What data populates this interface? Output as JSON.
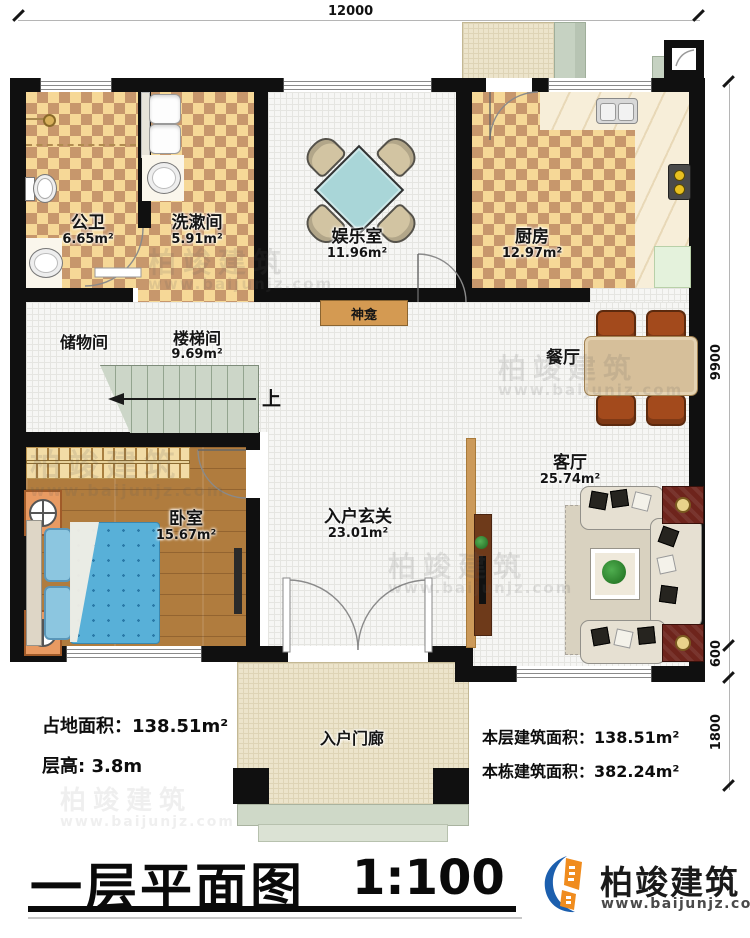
{
  "title": {
    "text": "一层平面图",
    "scale": "1:100"
  },
  "brand": {
    "name": "柏竣建筑",
    "url": "www.baijunjz.com"
  },
  "watermark": {
    "name": "柏竣建筑",
    "url": "www.baijunjz.com"
  },
  "dimensions": {
    "top": "12000",
    "right_upper": "9900",
    "right_mid": "600",
    "right_lower": "1800"
  },
  "stats": {
    "land_area": "占地面积：138.51m²",
    "floor_height": "层高: 3.8m",
    "floor_area": "本层建筑面积：138.51m²",
    "building_area": "本栋建筑面积：382.24m²"
  },
  "rooms": {
    "bathroom": {
      "name": "公卫",
      "area": "6.65m²"
    },
    "washroom": {
      "name": "洗漱间",
      "area": "5.91m²"
    },
    "entertainment": {
      "name": "娱乐室",
      "area": "11.96m²"
    },
    "kitchen": {
      "name": "厨房",
      "area": "12.97m²"
    },
    "storage": {
      "name": "储物间"
    },
    "stairwell": {
      "name": "楼梯间",
      "area": "9.69m²"
    },
    "stairs_direction": "上",
    "shrine": {
      "name": "神龛"
    },
    "dining": {
      "name": "餐厅"
    },
    "living": {
      "name": "客厅",
      "area": "25.74m²"
    },
    "bedroom": {
      "name": "卧室",
      "area": "15.67m²"
    },
    "foyer": {
      "name": "入户玄关",
      "area": "23.01m²"
    },
    "porch": {
      "name": "入户门廊"
    }
  },
  "colors": {
    "wall": "#101010",
    "checker_light": "#f6d897",
    "checker_dark": "#c7976c",
    "wood_floor": "#b07c3e",
    "stair": "#ccd6c8",
    "shrine_bar": "#d49a52",
    "table_teal": "#a9d6d8",
    "bed_blue": "#58b0d8",
    "brand_blue": "#1c5fae",
    "brand_orange": "#f08c1e"
  }
}
